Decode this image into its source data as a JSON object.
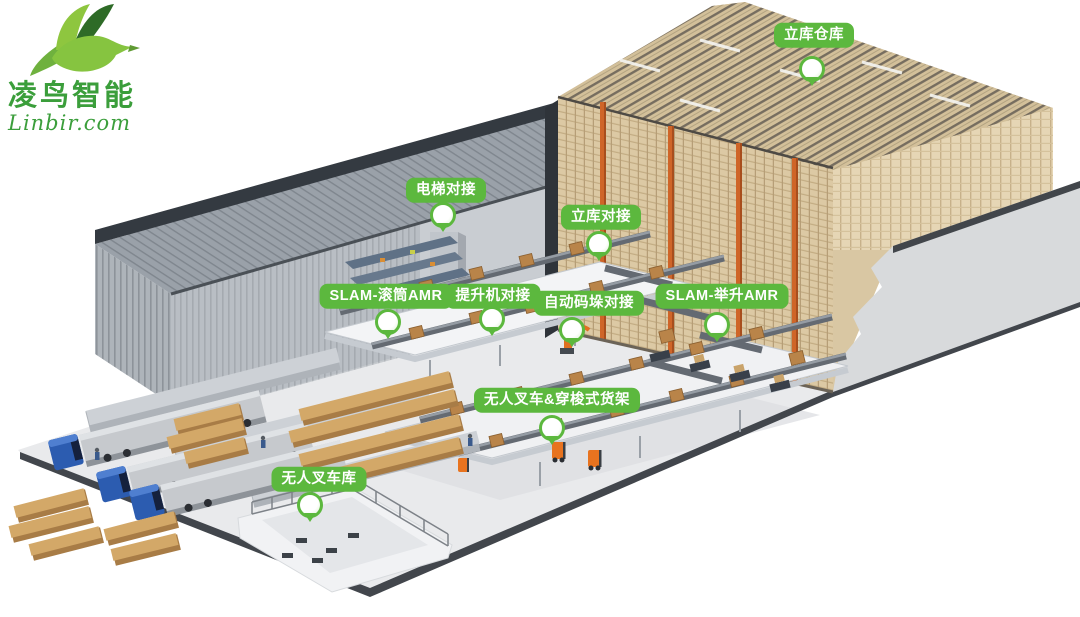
{
  "logo": {
    "company_name": "凌鸟智能",
    "website": "Linbir.com"
  },
  "callouts": [
    {
      "id": "asrs-warehouse",
      "text": "立库仓库"
    },
    {
      "id": "elevator-docking",
      "text": "电梯对接"
    },
    {
      "id": "asrs-docking",
      "text": "立库对接"
    },
    {
      "id": "slam-roller-amr",
      "text": "SLAM-滚筒AMR"
    },
    {
      "id": "hoist-docking",
      "text": "提升机对接"
    },
    {
      "id": "auto-palletizing-docking",
      "text": "自动码垛对接"
    },
    {
      "id": "slam-lifting-amr",
      "text": "SLAM-举升AMR"
    },
    {
      "id": "forklift-shuttle-rack",
      "text": "无人叉车&穿梭式货架"
    },
    {
      "id": "forklift-garage",
      "text": "无人叉车库"
    }
  ],
  "colors": {
    "callout_green": "#5cb83e",
    "logo_green": "#3b9e3b",
    "rack_tan": "#dcc9a4",
    "crane_orange": "#cf6528",
    "truck_blue": "#2c5cb0",
    "ground_gray": "#e9eaec"
  },
  "scene_elements": [
    "left-warehouse-building",
    "asrs-rack-block",
    "cutaway-wall",
    "mezzanine-floors",
    "conveyor-lines",
    "cardboard-boxes",
    "dock-platforms",
    "trucks",
    "fenced-forklift-area",
    "agv-robots"
  ]
}
